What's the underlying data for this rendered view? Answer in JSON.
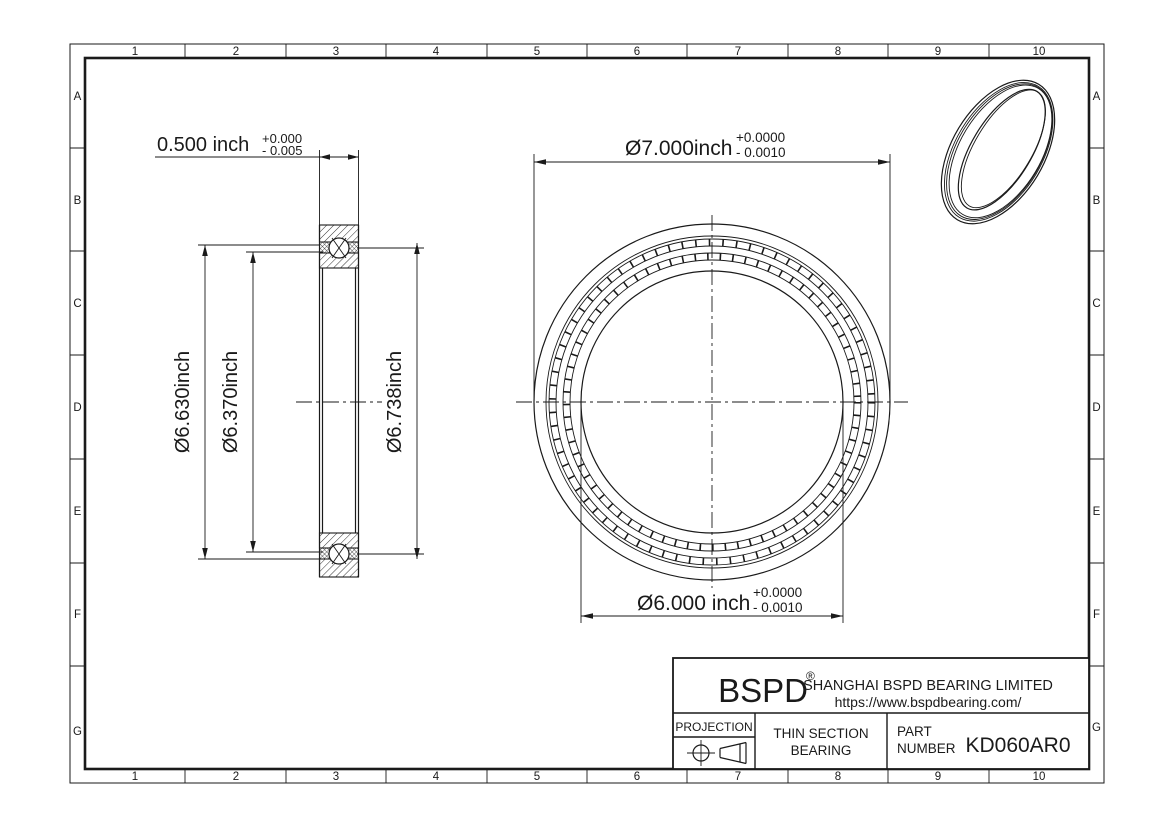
{
  "border": {
    "columns": [
      "1",
      "2",
      "3",
      "4",
      "5",
      "6",
      "7",
      "8",
      "9",
      "10"
    ],
    "rows": [
      "A",
      "B",
      "C",
      "D",
      "E",
      "F",
      "G"
    ]
  },
  "side_view": {
    "width_dim": {
      "value": "0.500 inch",
      "tol_plus": "+0.000",
      "tol_minus": "- 0.005"
    },
    "outer_land_dim": "Ø6.630inch",
    "inner_land_dim": "Ø6.370inch",
    "raceway_dim": "Ø6.738inch"
  },
  "front_view": {
    "od_dim": {
      "value": "Ø7.000inch",
      "tol_plus": "+0.0000",
      "tol_minus": "- 0.0010"
    },
    "bore_dim": {
      "value": "Ø6.000 inch",
      "tol_plus": "+0.0000",
      "tol_minus": "- 0.0010"
    }
  },
  "title_block": {
    "brand": "BSPD",
    "registered": "®",
    "company": "SHANGHAI BSPD BEARING LIMITED",
    "website": "https://www.bspdbearing.com/",
    "projection_label": "PROJECTION",
    "product_type_line1": "THIN SECTION",
    "product_type_line2": "BEARING",
    "part_label_line1": "PART",
    "part_label_line2": "NUMBER",
    "part_number": "KD060AR0"
  },
  "colors": {
    "ink": "#1a1a1a",
    "paper": "#ffffff"
  }
}
